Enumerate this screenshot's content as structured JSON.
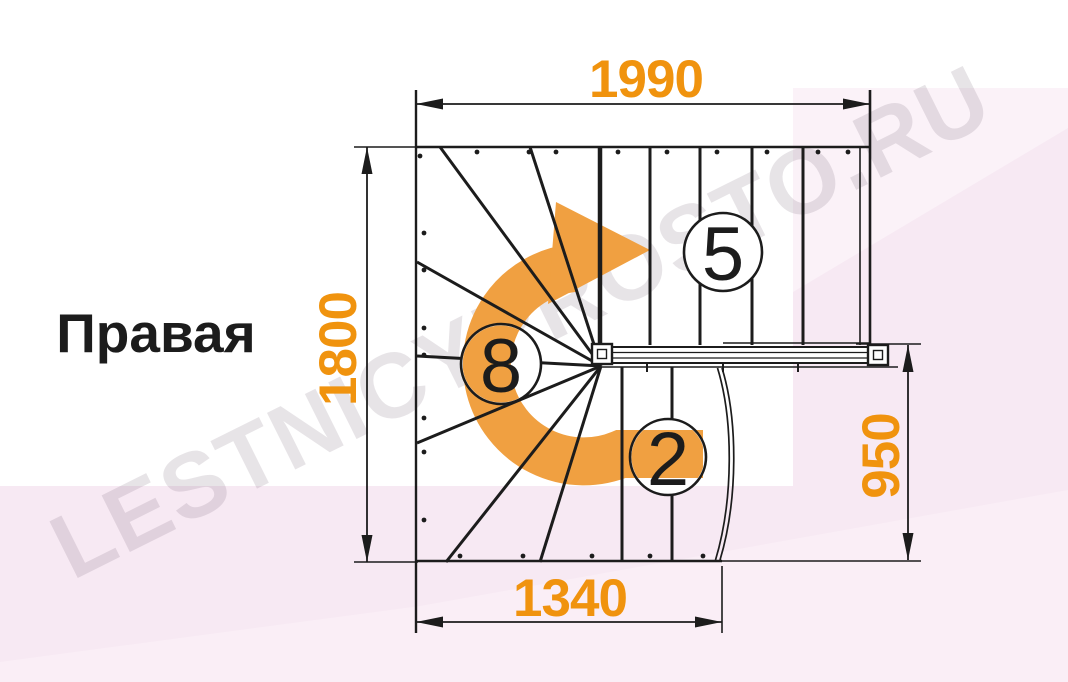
{
  "title": {
    "text": "Правая"
  },
  "watermark": {
    "text": "LESTNICYPROSTO.RU"
  },
  "dimensions": {
    "width_top": "1990",
    "height_left": "1800",
    "width_bottom": "1340",
    "height_right": "950"
  },
  "steps": {
    "upper_flight": "5",
    "winder": "8",
    "lower_flight": "2"
  },
  "colors": {
    "dimension_text": "#F0930E",
    "arrow_orange": "#F0A041",
    "linework": "#1C1C1C",
    "background_pink": "#F7E9F3",
    "background_pink_light": "#FBF2F8",
    "background_pink_soft": "#FAEEF6",
    "watermark_gray": "#6B5A6B"
  }
}
